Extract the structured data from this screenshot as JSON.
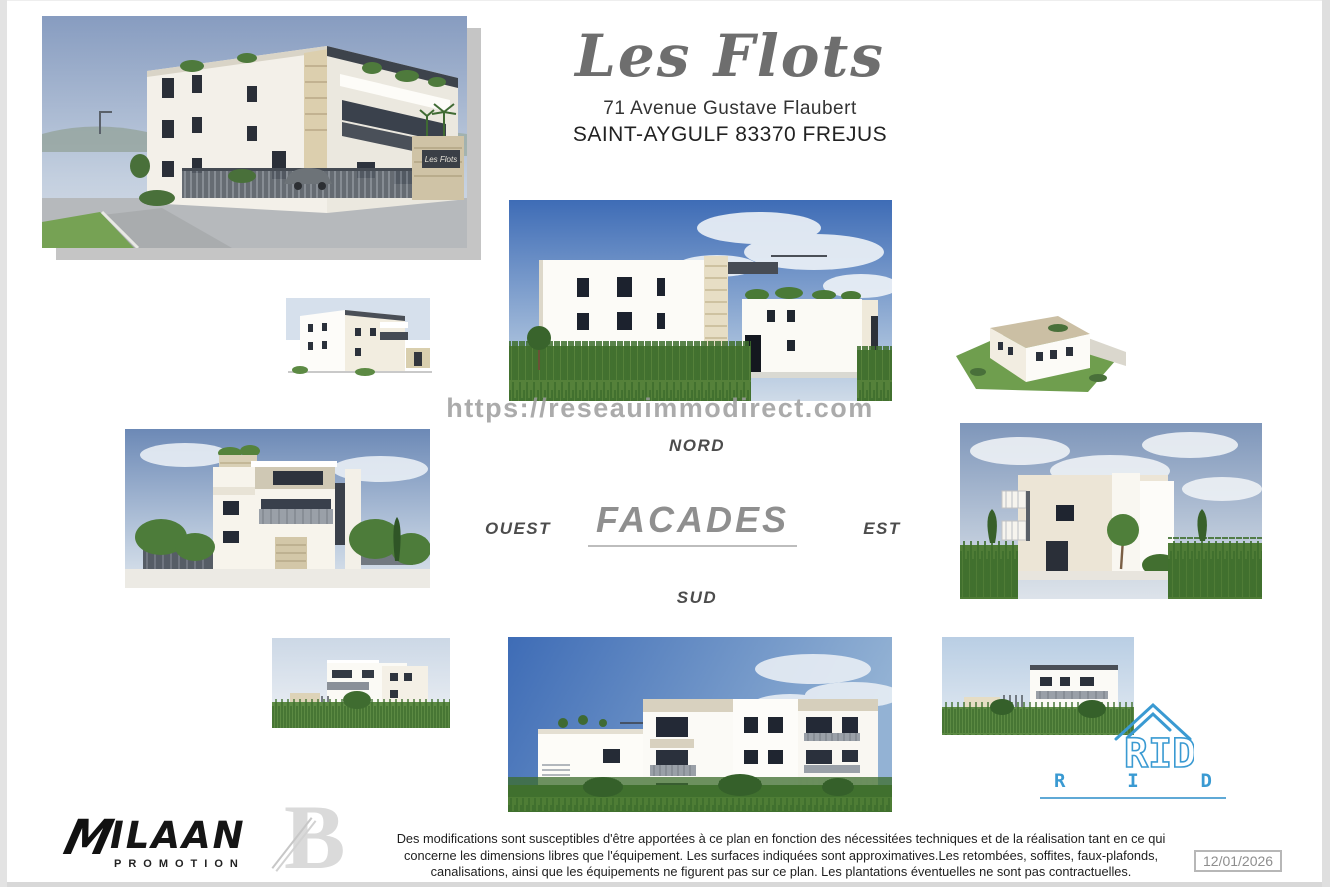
{
  "header": {
    "title": "Les Flots",
    "address_line1": "71 Avenue Gustave Flaubert",
    "address_line2": "SAINT-AYGULF 83370 FREJUS"
  },
  "watermark": "https://reseauimmodirect.com",
  "facades": {
    "section_title": "FACADES",
    "north_label": "NORD",
    "west_label": "OUEST",
    "east_label": "EST",
    "south_label": "SUD"
  },
  "hero": {
    "gate_sign": "Les Flots"
  },
  "footer": {
    "disclaimer_line1": "Des modifications sont susceptibles d'être apportées à ce plan en fonction des nécessitées techniques et de la réalisation tant en ce qui",
    "disclaimer_line2": "concerne les dimensions libres que l'équipement.  Les surfaces indiquées sont approximatives.Les retombées, soffites, faux-plafonds,",
    "disclaimer_line3": "canalisations, ainsi que les équipements ne figurent pas sur ce plan. Les plantations éventuelles ne sont pas contractuelles.",
    "date_stamp": "12/01/2026",
    "ilaan_logo": {
      "mark": "M",
      "name": "ILAAN",
      "subtitle": "PROMOTION"
    },
    "architect_logo": {
      "letter": "B"
    },
    "rid_logo": {
      "icon_text": "RID",
      "letters": [
        "R",
        "I",
        "D"
      ]
    }
  },
  "colors": {
    "accent_blue": "#3a9ad2",
    "title_gray": "#6e6e6e",
    "watermark_gray": "#9d9d9d",
    "facades_gray": "#8f8f8f",
    "sky_blue": "#3e6cb6",
    "grass_green": "#4e7d35"
  }
}
